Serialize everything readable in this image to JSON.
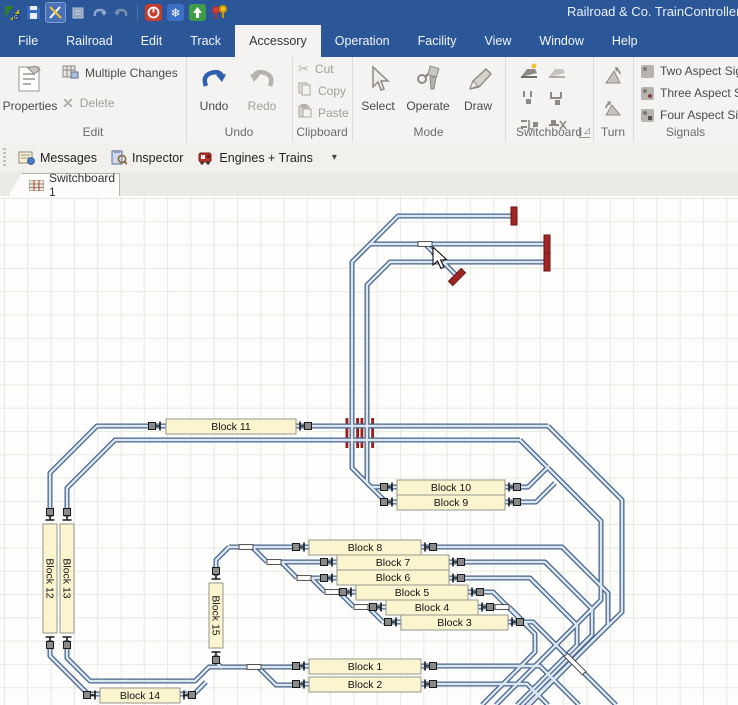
{
  "colors": {
    "titlebar": "#2b5799",
    "track": "#47658c",
    "track_core": "#dce6ef",
    "block_fill": "#faf4cf",
    "block_border": "#97978f",
    "block_text": "#111111",
    "buffer": "#a02525",
    "crossing": "#9b1b1b",
    "undo_accent": "#2f5fae"
  },
  "title_bar": {
    "title": "Railroad & Co. TrainController G",
    "quick_icons": [
      "app-logo-icon",
      "save-icon",
      "edit-tools-icon",
      "copy-doc-icon",
      "undo-small-icon",
      "redo-small-icon",
      "stop-icon",
      "freeze-icon",
      "power-up-icon",
      "accessory-pins-icon"
    ]
  },
  "menu": {
    "items": [
      "File",
      "Railroad",
      "Edit",
      "Track",
      "Accessory",
      "Operation",
      "Facility",
      "View",
      "Window",
      "Help"
    ],
    "active": "Accessory"
  },
  "ribbon": {
    "groups": [
      {
        "label": "Edit"
      },
      {
        "label": "Undo"
      },
      {
        "label": "Clipboard"
      },
      {
        "label": "Mode"
      },
      {
        "label": "Switchboard"
      },
      {
        "label": "Turn"
      },
      {
        "label": "Signals"
      }
    ],
    "buttons": {
      "properties": "Properties",
      "multiple_changes": "Multiple Changes",
      "delete": "Delete",
      "undo": "Undo",
      "redo": "Redo",
      "cut": "Cut",
      "copy": "Copy",
      "paste": "Paste",
      "select": "Select",
      "operate": "Operate",
      "draw": "Draw",
      "two_aspect": "Two Aspect Sig",
      "three_aspect": "Three Aspect Si",
      "four_aspect": "Four Aspect Sig"
    }
  },
  "toolbar": {
    "items": [
      {
        "label": "Messages",
        "icon": "messages-icon"
      },
      {
        "label": "Inspector",
        "icon": "inspector-icon"
      },
      {
        "label": "Engines + Trains",
        "icon": "engines-icon"
      }
    ],
    "dropdown": "▾"
  },
  "tabs": [
    {
      "label": "Switchboard 1"
    }
  ],
  "switchboard": {
    "blocks": [
      {
        "label": "Block 11",
        "x": 166,
        "y": 419,
        "w": 130,
        "h": 15,
        "orient": "h",
        "icons": [
          [
            157,
            426,
            "l"
          ],
          [
            303,
            426,
            "r"
          ]
        ]
      },
      {
        "label": "Block 10",
        "x": 397,
        "y": 480,
        "w": 108,
        "h": 15,
        "orient": "h",
        "icons": [
          [
            389,
            487,
            "l"
          ],
          [
            512,
            487,
            "r"
          ]
        ]
      },
      {
        "label": "Block 9",
        "x": 397,
        "y": 495,
        "w": 108,
        "h": 15,
        "orient": "h",
        "icons": [
          [
            389,
            502,
            "l"
          ],
          [
            512,
            502,
            "r"
          ]
        ]
      },
      {
        "label": "Block 8",
        "x": 309,
        "y": 540,
        "w": 112,
        "h": 15,
        "orient": "h",
        "icons": [
          [
            301,
            547,
            "l"
          ],
          [
            428,
            547,
            "r"
          ]
        ]
      },
      {
        "label": "Block 7",
        "x": 337,
        "y": 555,
        "w": 112,
        "h": 15,
        "orient": "h",
        "icons": [
          [
            329,
            562,
            "l"
          ],
          [
            456,
            562,
            "r"
          ]
        ]
      },
      {
        "label": "Block 6",
        "x": 337,
        "y": 570,
        "w": 112,
        "h": 15,
        "orient": "h",
        "icons": [
          [
            329,
            578,
            "l"
          ],
          [
            456,
            578,
            "r"
          ]
        ]
      },
      {
        "label": "Block 5",
        "x": 356,
        "y": 585,
        "w": 112,
        "h": 15,
        "orient": "h",
        "icons": [
          [
            348,
            592,
            "l"
          ],
          [
            475,
            592,
            "r"
          ]
        ]
      },
      {
        "label": "Block 4",
        "x": 386,
        "y": 600,
        "w": 92,
        "h": 15,
        "orient": "h",
        "icons": [
          [
            378,
            607,
            "l"
          ],
          [
            485,
            607,
            "r"
          ]
        ]
      },
      {
        "label": "Block 3",
        "x": 401,
        "y": 615,
        "w": 107,
        "h": 15,
        "orient": "h",
        "icons": [
          [
            393,
            622,
            "l"
          ],
          [
            515,
            622,
            "r"
          ]
        ]
      },
      {
        "label": "Block 1",
        "x": 309,
        "y": 659,
        "w": 112,
        "h": 15,
        "orient": "h",
        "icons": [
          [
            301,
            666,
            "l"
          ],
          [
            428,
            666,
            "r"
          ]
        ]
      },
      {
        "label": "Block 2",
        "x": 309,
        "y": 677,
        "w": 112,
        "h": 15,
        "orient": "h",
        "icons": [
          [
            301,
            684,
            "l"
          ],
          [
            428,
            684,
            "r"
          ]
        ]
      },
      {
        "label": "Block 14",
        "x": 100,
        "y": 688,
        "w": 80,
        "h": 15,
        "orient": "h",
        "icons": [
          [
            92,
            695,
            "l"
          ],
          [
            187,
            695,
            "r"
          ]
        ]
      },
      {
        "label": "Block 12",
        "x": 43,
        "y": 524,
        "w": 14,
        "h": 109,
        "orient": "v",
        "icons": [
          [
            50,
            517,
            "t"
          ],
          [
            50,
            640,
            "b"
          ]
        ]
      },
      {
        "label": "Block 13",
        "x": 60,
        "y": 524,
        "w": 14,
        "h": 109,
        "orient": "v",
        "icons": [
          [
            67,
            517,
            "t"
          ],
          [
            67,
            640,
            "b"
          ]
        ]
      },
      {
        "label": "Block 15",
        "x": 209,
        "y": 583,
        "w": 14,
        "h": 65,
        "orient": "v",
        "icons": [
          [
            216,
            576,
            "t"
          ],
          [
            216,
            655,
            "b"
          ]
        ]
      }
    ],
    "tracks": [
      "M515,216 H398 L352,262 V468 L371,487 H519",
      "M546,244 H370",
      "M425,244 L456,275",
      "M546,262 H390 L367,285 V483 L386,502 H519",
      "M548,426 H97 L50,473 V517",
      "M548,426 L622,500 V612 L527,705",
      "M520,440 H115 L67,488 V517",
      "M520,440 L601,521 V600 L496,705",
      "M519,487 H528 L549,466",
      "M519,502 H536 L555,483",
      "M229,547 H562 L608,593 V625 L529,705",
      "M216,576 V560 L229,547",
      "M252,547 L267,562",
      "M267,562 H545 L592,609 V635 L522,705",
      "M281,562 L297,578",
      "M297,578 H530 L577,625 V645 L517,705",
      "M311,578 L325,592",
      "M325,592 H493 L535,634 V652 L482,705",
      "M339,592 L354,607",
      "M354,607 H509",
      "M509,607 L528,626",
      "M368,607 L383,622",
      "M383,622 H533 L616,705",
      "M67,640 V658 L90,681 H195 L209,667 H301",
      "M258,667 L276,685 H301",
      "M216,655 V662 L222,668",
      "M50,640 V656 L88,694 H187",
      "M187,695 H193 L206,682",
      "M301,666 H428",
      "M428,666 H540 L567,693 L579,705",
      "M301,684 H428",
      "M428,684 H527 L545,702 L548,705"
    ],
    "turnouts": [
      [
        425,
        244,
        14,
        0
      ],
      [
        438,
        257,
        13,
        45
      ],
      [
        246,
        547,
        14,
        0
      ],
      [
        274,
        562,
        14,
        0
      ],
      [
        304,
        578,
        14,
        0
      ],
      [
        332,
        592,
        14,
        0
      ],
      [
        361,
        607,
        14,
        0
      ],
      [
        502,
        607,
        14,
        0
      ],
      [
        254,
        667,
        14,
        0
      ],
      [
        575,
        664,
        26,
        45
      ]
    ],
    "buffers": [
      [
        514,
        216,
        0
      ],
      [
        547,
        244,
        0
      ],
      [
        547,
        262,
        0
      ],
      [
        457,
        277,
        45
      ]
    ],
    "crossings": {
      "verticals": [
        352,
        367
      ],
      "y": 418,
      "h": 30,
      "offsets": [
        -6.5,
        4.2
      ],
      "bar_w": 2.8
    },
    "cursor": {
      "points": "433,247 433,265 437.5,261 441,268.5 444,267 440.5,260 446.5,259.5"
    }
  }
}
